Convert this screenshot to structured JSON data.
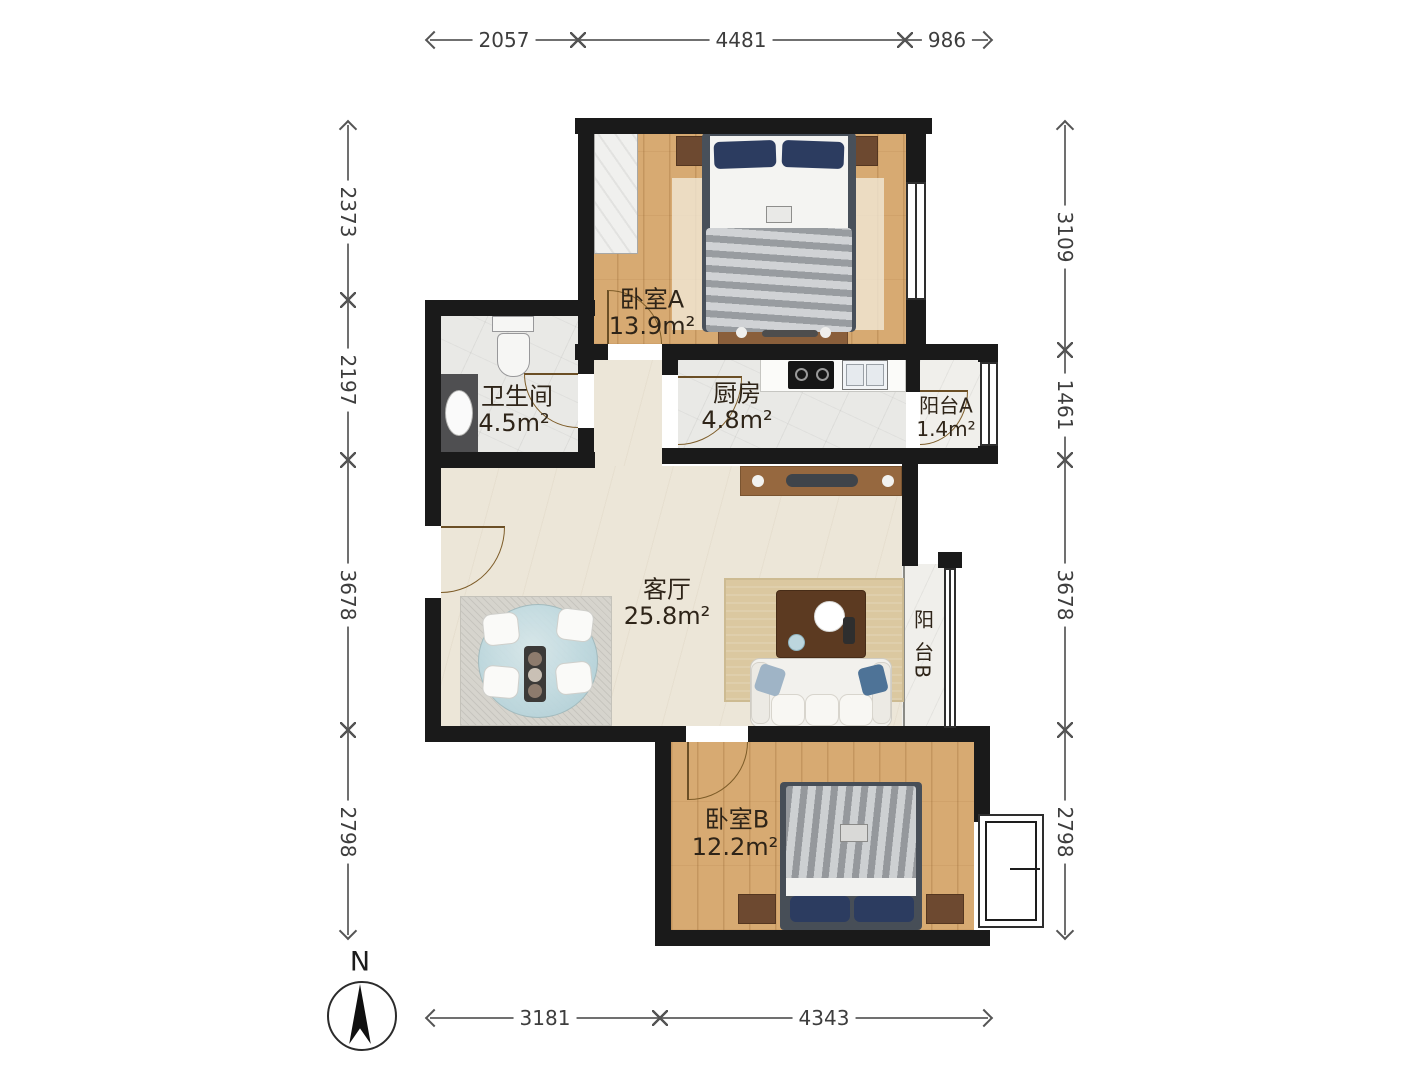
{
  "compass": {
    "label": "N"
  },
  "dims": {
    "top": [
      "2057",
      "4481",
      "986"
    ],
    "bottom": [
      "3181",
      "4343"
    ],
    "left": [
      "2373",
      "2197",
      "3678",
      "2798"
    ],
    "right": [
      "3109",
      "1461",
      "3678",
      "2798"
    ]
  },
  "rooms": {
    "bedroomA": {
      "name": "卧室A",
      "area": "13.9m²"
    },
    "bathroom": {
      "name": "卫生间",
      "area": "4.5m²"
    },
    "kitchen": {
      "name": "厨房",
      "area": "4.8m²"
    },
    "balconyA": {
      "name": "阳台A",
      "area": "1.4m²"
    },
    "living": {
      "name": "客厅",
      "area": "25.8m²"
    },
    "balconyB": {
      "name": "阳 台B"
    },
    "bedroomB": {
      "name": "卧室B",
      "area": "12.2m²"
    }
  },
  "colors": {
    "wall": "#1a1a1a",
    "wood_floor": "#d7aa72",
    "tile_floor": "#e9e9e6",
    "living_floor": "#ece6d8",
    "pillow_navy": "#2c3c60",
    "furniture_brown": "#6d4930"
  }
}
